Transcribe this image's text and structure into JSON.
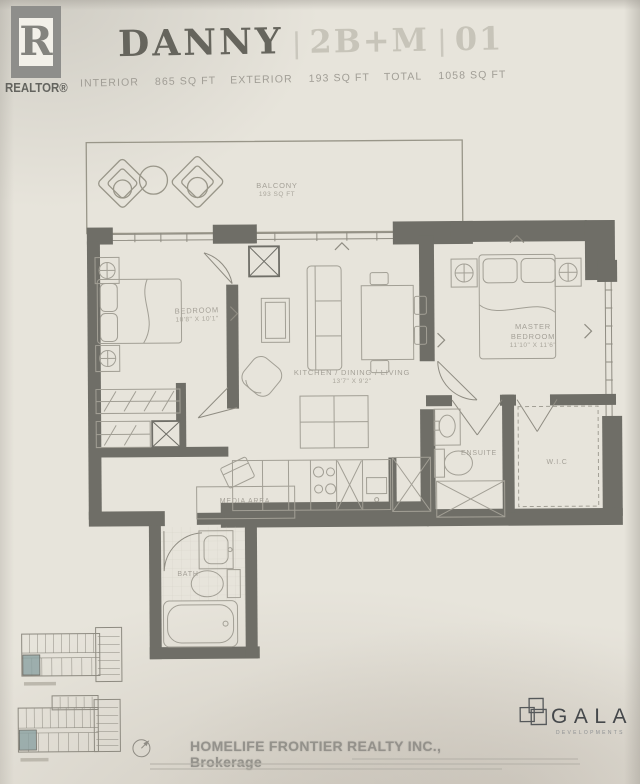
{
  "header": {
    "realtor_logo": {
      "letter": "R",
      "label": "REALTOR®"
    },
    "title": "DANNY",
    "separator": "|",
    "unit_model": "2B+M",
    "unit_number": "01",
    "stats": [
      {
        "label": "INTERIOR",
        "value": "865 SQ FT"
      },
      {
        "label": "EXTERIOR",
        "value": "193 SQ FT"
      },
      {
        "label": "TOTAL",
        "value": "1058 SQ FT"
      }
    ]
  },
  "plan": {
    "rooms": {
      "balcony": {
        "name": "BALCONY",
        "dim": "193 SQ FT"
      },
      "bedroom": {
        "name": "BEDROOM",
        "dim": "10'8\" X 10'1\""
      },
      "master": {
        "name": "MASTER BEDROOM",
        "dim": "11'10\" X 11'6\""
      },
      "living": {
        "name": "KITCHEN / DINING / LIVING",
        "dim": "13'7\" X 9'2\""
      },
      "media": {
        "name": "MEDIA AREA"
      },
      "ensuite": {
        "name": "ENSUITE"
      },
      "wic": {
        "name": "W.I.C"
      },
      "bath": {
        "name": "BATH"
      }
    }
  },
  "footer": {
    "brokerage": "HOMELIFE FRONTIER REALTY INC., Brokerage",
    "developer_name": "GALA",
    "developer_tagline": "DEVELOPMENTS"
  },
  "colors": {
    "paper": "#e7e4db",
    "wall": "#6f6e67",
    "line": "#a29f95",
    "unit_highlight": "#8ba1a1",
    "title_dark": "#66655d",
    "title_faint": "#c7c4b9"
  }
}
